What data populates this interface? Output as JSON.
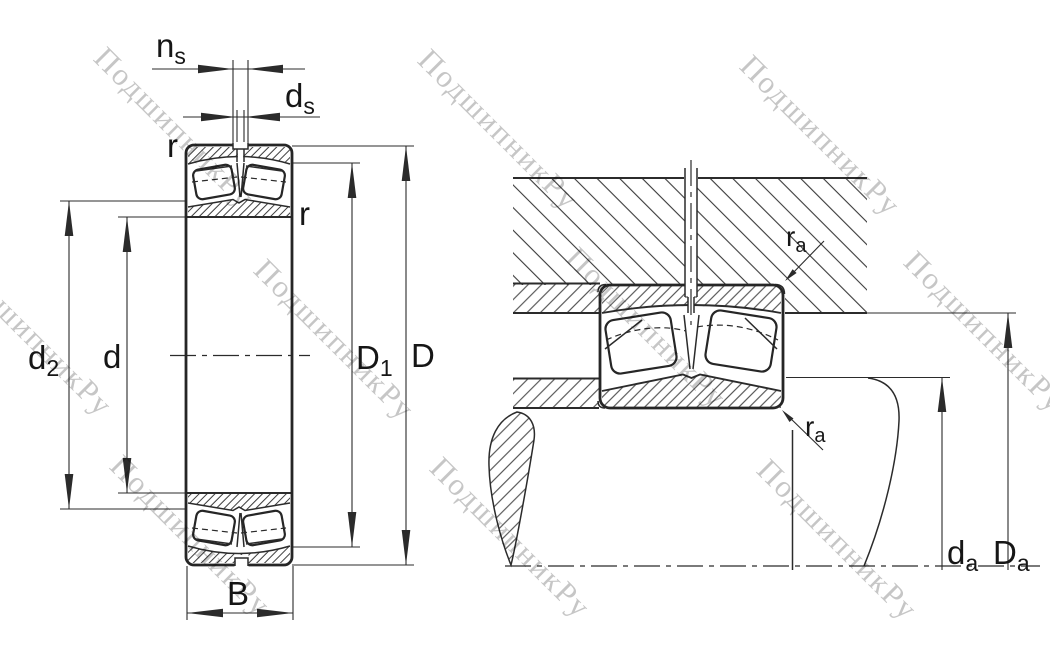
{
  "drawing_title": "spherical-roller-bearing-dimension-drawing",
  "section_view": {
    "dim_ns": {
      "base": "n",
      "sub": "s"
    },
    "dim_ds": {
      "base": "d",
      "sub": "s"
    },
    "chamfer_outer": "r",
    "chamfer_bore": "r",
    "dim_d2": {
      "base": "d",
      "sub": "2"
    },
    "dim_d": {
      "base": "d"
    },
    "dim_D1": {
      "base": "D",
      "sub": "1"
    },
    "dim_D": {
      "base": "D"
    },
    "dim_B": {
      "base": "B"
    }
  },
  "mounting_view": {
    "fillet_housing": {
      "base": "r",
      "sub": "a"
    },
    "fillet_shaft": {
      "base": "r",
      "sub": "a"
    },
    "dim_da": {
      "base": "d",
      "sub": "a"
    },
    "dim_Da": {
      "base": "D",
      "sub": "a"
    }
  },
  "watermark": {
    "text": "ПодшипникРу",
    "color": "#c6c6c6"
  },
  "colors": {
    "line": "#2b2b2b",
    "hatch": "#3a3a3a",
    "label": "#161616",
    "background": "#ffffff"
  }
}
